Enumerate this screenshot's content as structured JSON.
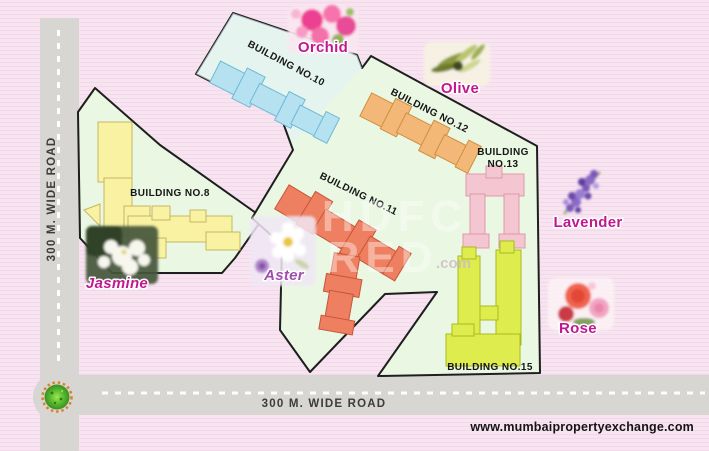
{
  "colors": {
    "background_pink": "#f8e4f1",
    "plot_green": "#eaf8e3",
    "plot_blue_tint": "#e2f1f4",
    "road_gray": "#d7d6d3",
    "building8": "#f8f2a2",
    "building10": "#b5e1f0",
    "building11": "#ee7f60",
    "building12": "#f3b878",
    "building13": "#f3c6d2",
    "building15": "#dfec4e",
    "flower_label": "#c2188f",
    "flower_label_aster": "#a14cb0",
    "outline_black": "#1e1e1e"
  },
  "roads": {
    "vertical_label": "300 M. WIDE ROAD",
    "horizontal_label": "300 M. WIDE ROAD"
  },
  "buildings": {
    "b8": {
      "label": "BUILDING NO.8"
    },
    "b10": {
      "label": "BUILDING NO.10"
    },
    "b11": {
      "label": "BUILDING NO.11"
    },
    "b12": {
      "label": "BUILDING NO.12"
    },
    "b13": {
      "line1": "BUILDING",
      "line2": "NO.13"
    },
    "b15": {
      "label": "BUILDING NO.15"
    }
  },
  "flowers": {
    "orchid": "Orchid",
    "olive": "Olive",
    "lavender": "Lavender",
    "rose": "Rose",
    "jasmine": "Jasmine",
    "aster": "Aster"
  },
  "watermark": {
    "line1": "HDFC",
    "line2": "RED",
    "suffix": ".com"
  },
  "footer": {
    "website": "www.mumbaipropertyexchange.com"
  }
}
